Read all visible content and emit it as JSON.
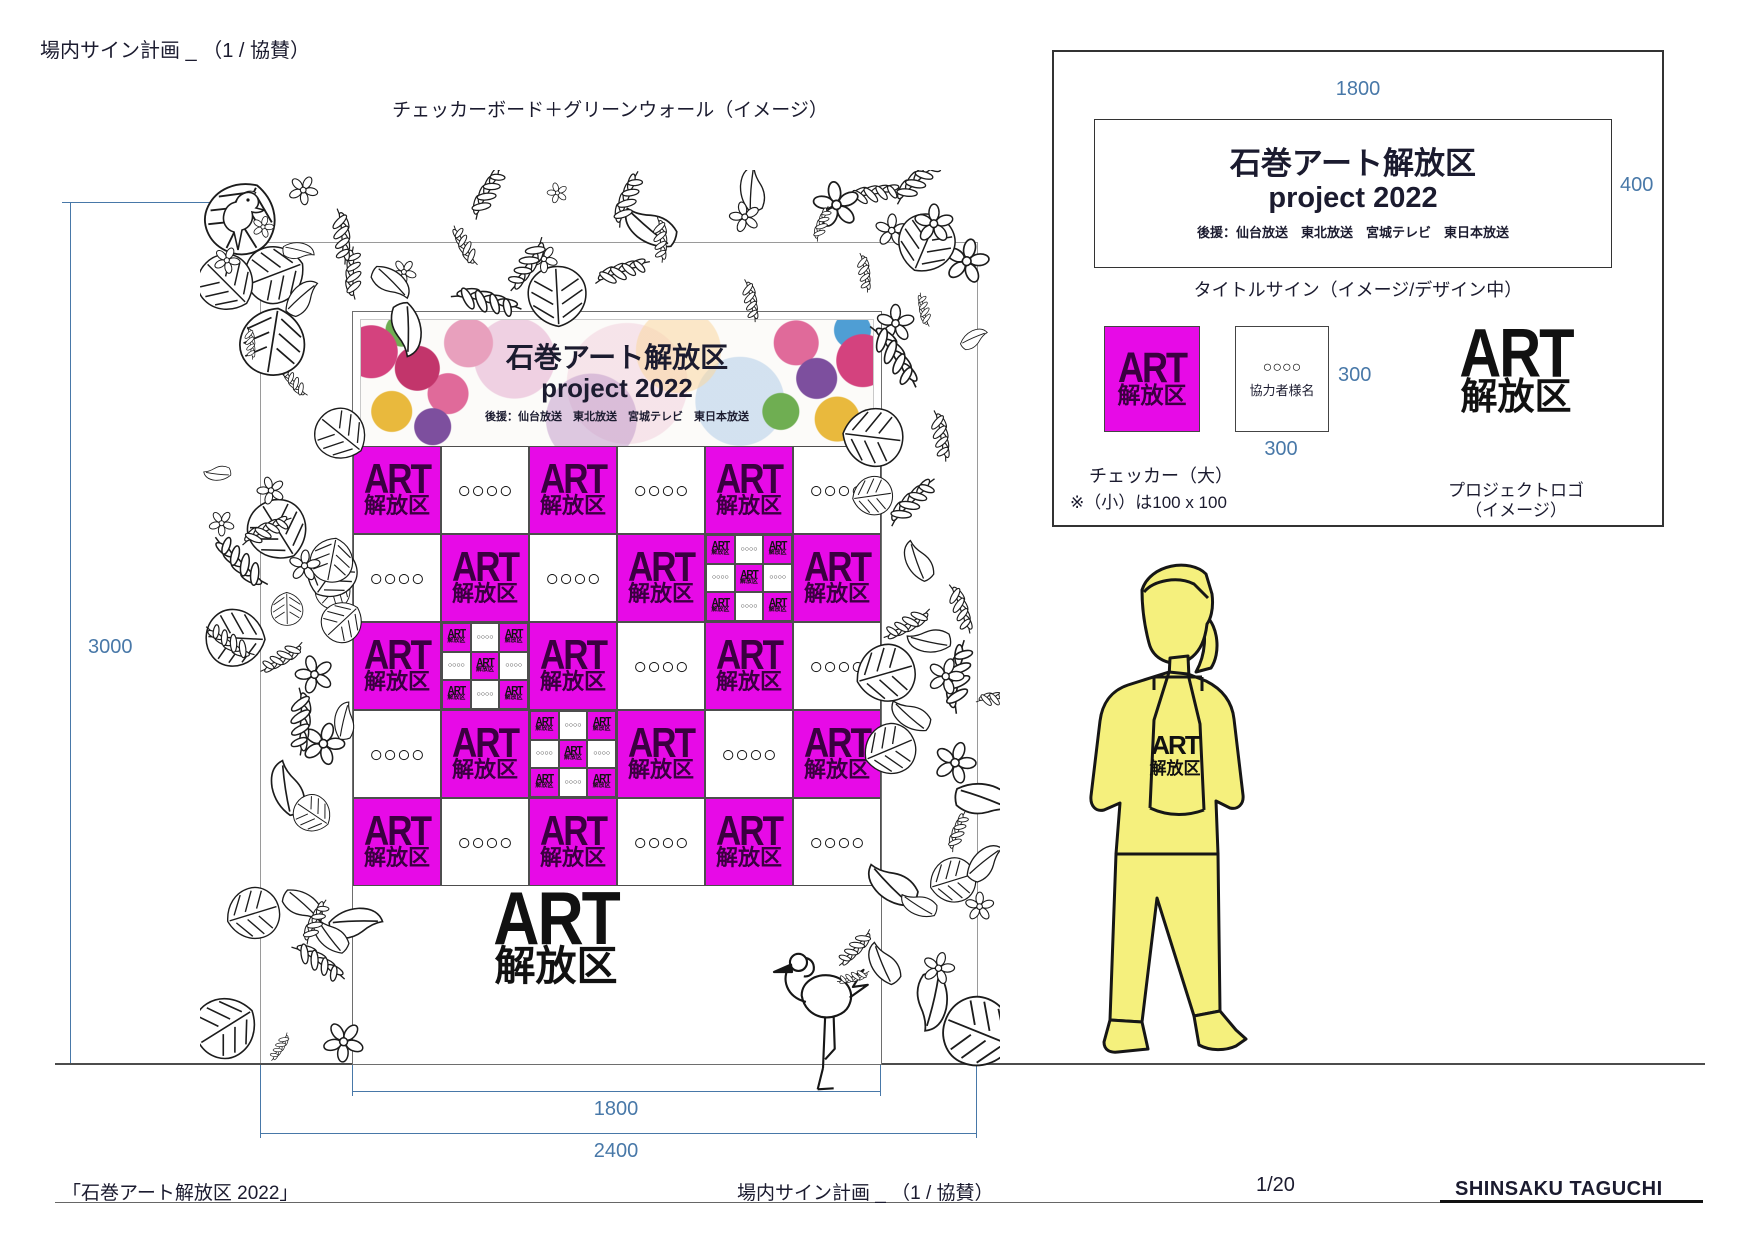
{
  "page": {
    "title": "場内サイン計画 _ （1 / 協賛）",
    "mockup_caption": "チェッカーボード＋グリーンウォール（イメージ）"
  },
  "logo": {
    "line1": "ART",
    "line2": "解放区"
  },
  "banner": {
    "title_line1": "石巻アート解放区",
    "title_line2": "project 2022",
    "sponsors": "後援：仙台放送　東北放送　宮城テレビ　東日本放送"
  },
  "checkerboard": {
    "magenta_color": "#e70ae7",
    "placeholder_circles": "○○○○",
    "rows": [
      [
        "M",
        "W",
        "M",
        "W",
        "M",
        "W"
      ],
      [
        "W",
        "M",
        "W",
        "M",
        "X",
        "M"
      ],
      [
        "M",
        "X",
        "M",
        "W",
        "M",
        "W"
      ],
      [
        "W",
        "M",
        "X",
        "M",
        "W",
        "M"
      ],
      [
        "M",
        "W",
        "M",
        "W",
        "M",
        "W"
      ]
    ],
    "mini_pattern": [
      [
        "M",
        "W",
        "M"
      ],
      [
        "W",
        "M",
        "W"
      ],
      [
        "M",
        "W",
        "M"
      ]
    ]
  },
  "dimensions": {
    "color": "#4878a8",
    "wall_height": "3000",
    "inner_width": "1800",
    "outer_width": "2400"
  },
  "detail_panel": {
    "sign_width": "1800",
    "sign_height": "400",
    "sign_title_line1": "石巻アート解放区",
    "sign_title_line2": "project 2022",
    "sign_sponsors": "後援：仙台放送　東北放送　宮城テレビ　東日本放送",
    "sign_caption": "タイトルサイン（イメージ/デザイン中）",
    "checker_width": "300",
    "checker_height": "300",
    "cooperator_circles": "○○○○",
    "cooperator_label": "協力者様名",
    "checker_caption": "チェッカー（大）",
    "checker_note": "※（小）は100 x 100",
    "logo_caption_line1": "プロジェクトロゴ",
    "logo_caption_line2": "（イメージ）"
  },
  "footer": {
    "left": "「石巻アート解放区 2022」",
    "center": "場内サイン計画 _ （1 / 協賛）",
    "page_number": "1/20",
    "author": "SHINSAKU TAGUCHI"
  }
}
